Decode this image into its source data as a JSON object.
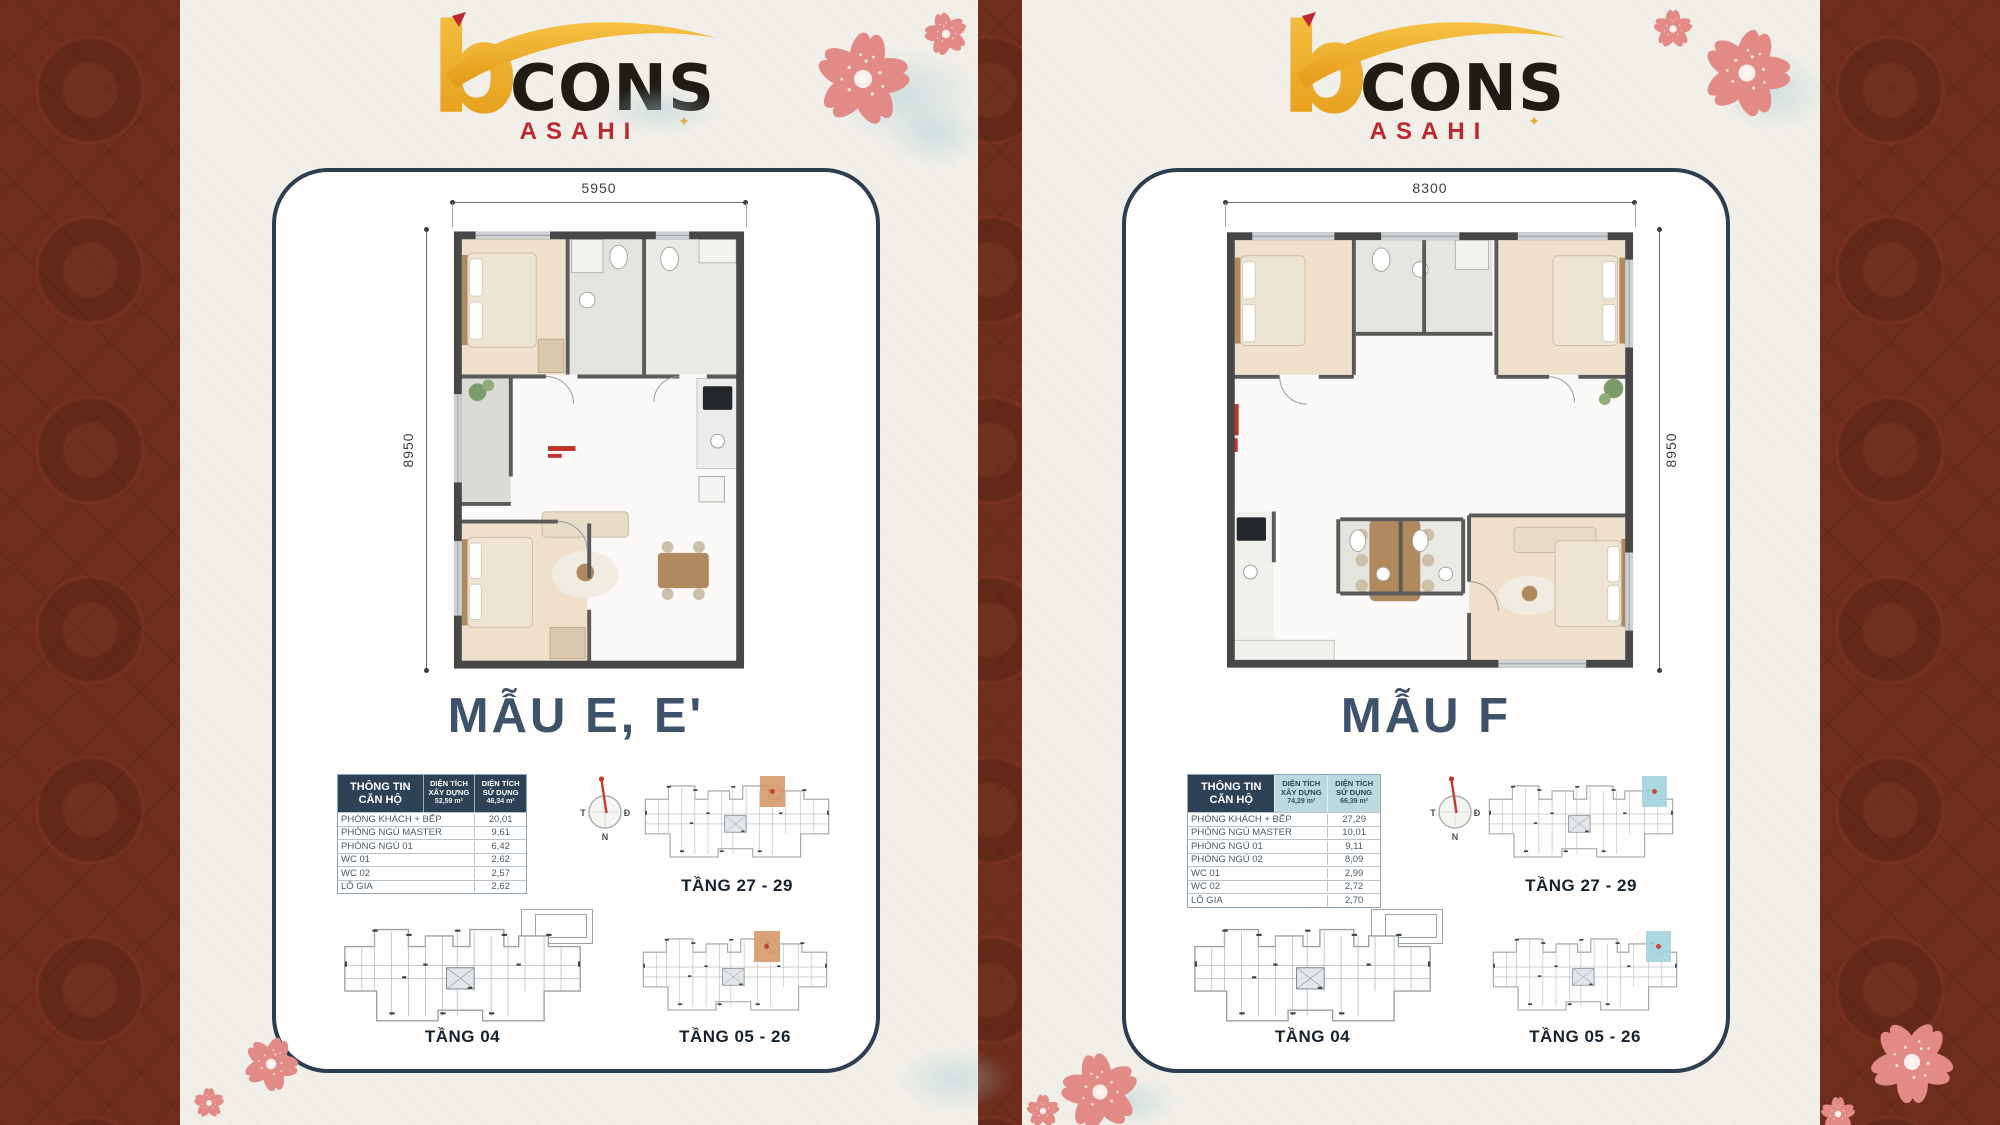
{
  "colors": {
    "border_brown": "#6f2d1c",
    "background_cream": "#f1efe8",
    "card_border_navy": "#2d3e52",
    "title_navy": "#3d526b",
    "table_header_navy": "#2d4257",
    "table_header_teal": "#bcd9dd",
    "brand_gold": "#eeb033",
    "brand_black": "#201b15",
    "brand_red": "#bf2730",
    "sakura_pink": "#e28a86",
    "highlight_e": "#d69a6a",
    "highlight_f": "#a3d4de"
  },
  "brand": {
    "b": "b",
    "cons": "CONS",
    "sub": "ASAHI"
  },
  "panels": [
    {
      "title": "MẪU E, E'",
      "dims": {
        "top": "5950",
        "side": "8950"
      },
      "compass": {
        "east": "Đ",
        "south": "N",
        "west": "T"
      },
      "table": {
        "header_info": [
          "THÔNG TIN",
          "CĂN HỘ"
        ],
        "header_build": [
          "DIỆN TÍCH",
          "XÂY DỰNG",
          "52,59 m²"
        ],
        "header_use": [
          "DIỆN TÍCH",
          "SỬ DỤNG",
          "46,34 m²"
        ],
        "header_accent_style": "background:#2d4257;color:#ffffff",
        "rows": [
          {
            "label": "PHÒNG KHÁCH + BẾP",
            "value": "20,01"
          },
          {
            "label": "PHÒNG NGỦ MASTER",
            "value": "9,61"
          },
          {
            "label": "PHÒNG NGỦ 01",
            "value": "6,42"
          },
          {
            "label": "WC 01",
            "value": "2,62"
          },
          {
            "label": "WC 02",
            "value": "2,57"
          },
          {
            "label": "LÔ GIA",
            "value": "2,62"
          }
        ]
      },
      "floors": {
        "top": "TẦNG 27 - 29",
        "bottom_left": "TẦNG 04",
        "bottom_right": "TẦNG 05 - 26"
      },
      "highlight_style": "background:#d69a6a"
    },
    {
      "title": "MẪU F",
      "dims": {
        "top": "8300",
        "side": "8950"
      },
      "compass": {
        "east": "Đ",
        "south": "N",
        "west": "T"
      },
      "table": {
        "header_info": [
          "THÔNG TIN",
          "CĂN HỘ"
        ],
        "header_build": [
          "DIỆN TÍCH",
          "XÂY DỰNG",
          "74,29 m²"
        ],
        "header_use": [
          "DIỆN TÍCH",
          "SỬ DỤNG",
          "66,39 m²"
        ],
        "header_accent_style": "background:#bcd9dd;color:#2d4257",
        "rows": [
          {
            "label": "PHÒNG KHÁCH + BẾP",
            "value": "27,29"
          },
          {
            "label": "PHÒNG NGỦ MASTER",
            "value": "10,01"
          },
          {
            "label": "PHÒNG NGỦ 01",
            "value": "9,11"
          },
          {
            "label": "PHÒNG NGỦ 02",
            "value": "8,09"
          },
          {
            "label": "WC 01",
            "value": "2,99"
          },
          {
            "label": "WC 02",
            "value": "2,72"
          },
          {
            "label": "LÔ GIA",
            "value": "2,70"
          }
        ]
      },
      "floors": {
        "top": "TẦNG 27 - 29",
        "bottom_left": "TẦNG 04",
        "bottom_right": "TẦNG 05 - 26"
      },
      "highlight_style": "background:#a3d4de"
    }
  ]
}
